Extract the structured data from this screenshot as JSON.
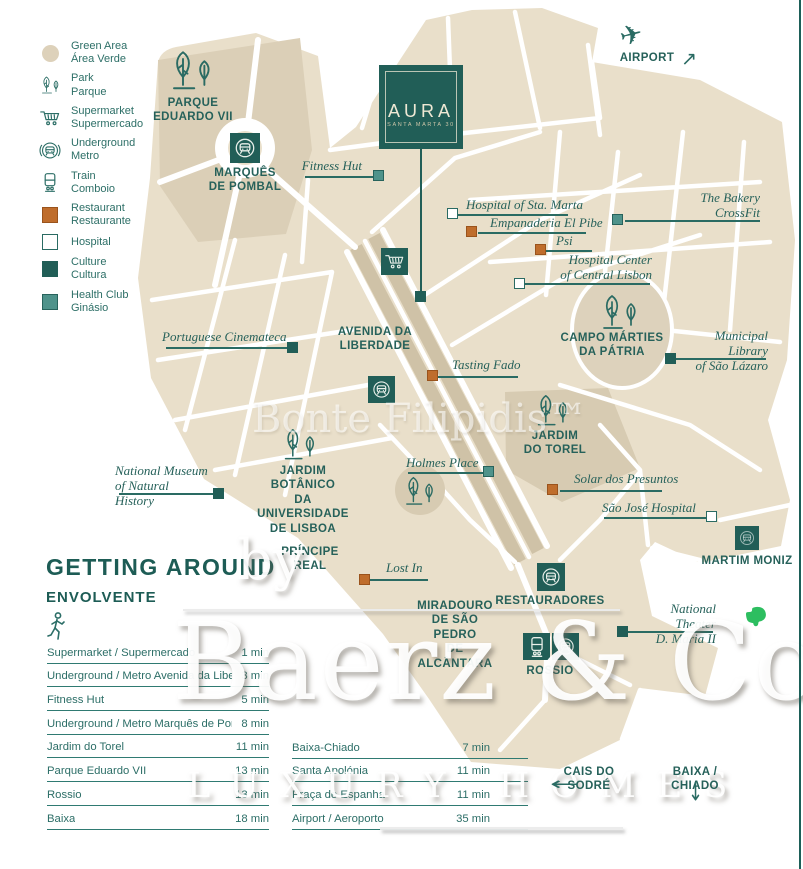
{
  "colors": {
    "teal": "#215e57",
    "teal_text": "#26615a",
    "orange": "#bf6d2c",
    "health_teal": "#4f938b",
    "beige": "#e9dfca",
    "evernote_green": "#2dbe60"
  },
  "icons": {
    "plane": "✈",
    "arrow_left": "←",
    "arrow_down": "↓",
    "arrow_up_right": "↗"
  },
  "legend": {
    "items": [
      {
        "id": "green-area",
        "label": "Green Area\nÁrea Verde"
      },
      {
        "id": "park",
        "label": "Park\nParque"
      },
      {
        "id": "supermarket",
        "label": "Supermarket\nSupermercado"
      },
      {
        "id": "underground",
        "label": "Underground\nMetro"
      },
      {
        "id": "train",
        "label": "Train\nComboio"
      },
      {
        "id": "restaurant",
        "label": "Restaurant\nRestaurante"
      },
      {
        "id": "hospital",
        "label": "Hospital"
      },
      {
        "id": "culture",
        "label": "Culture\nCultura"
      },
      {
        "id": "health-club",
        "label": "Health Club\nGinásio"
      }
    ]
  },
  "aura": {
    "title": "AURA",
    "subtitle": "SANTA MARTA 30"
  },
  "airport": {
    "label": "AIRPORT"
  },
  "areas": {
    "parque_eduardo": "PARQUE\nEDUARDO VII",
    "marques": "MARQUÊS\nDE POMBAL",
    "avenida": "AVENIDA DA\nLIBERDADE",
    "campo": "CAMPO MÁRTIES\nDA PÁTRIA",
    "torel": "JARDIM\nDO TOREL",
    "botanico": "JARDIM BOTÂNICO\nDA UNIVERSIDADE\nDE LISBOA",
    "principe": "PRÍNCIPE REAL",
    "martim": "MARTIM MONIZ",
    "restauradores": "RESTAURADORES",
    "miradouro": "MIRADOURO\nDE SÃO PEDRO\nDE ALCÂNTARA",
    "rossio": "ROSSIO",
    "cais": "CAIS DO SODRÉ",
    "baixa_chiado": "BAIXA / CHIADO"
  },
  "pois": {
    "fitness_hut": {
      "label": "Fitness Hut",
      "type": "health-club"
    },
    "sta_marta": {
      "label": "Hospital of Sta. Marta",
      "type": "hospital"
    },
    "empanaderia": {
      "label": "Empanaderia El Pibe",
      "type": "restaurant"
    },
    "psi": {
      "label": "Psi",
      "type": "restaurant"
    },
    "bakery": {
      "label": "The Bakery\nCrossFit",
      "type": "health-club"
    },
    "hospital_center": {
      "label": "Hospital Center\nof Central Lisbon",
      "type": "hospital"
    },
    "cinemateca": {
      "label": "Portuguese Cinemateca",
      "type": "culture"
    },
    "tasting_fado": {
      "label": "Tasting Fado",
      "type": "restaurant"
    },
    "library": {
      "label": "Municipal Library\nof São Lázaro",
      "type": "culture"
    },
    "holmes": {
      "label": "Holmes Place",
      "type": "health-club"
    },
    "solar": {
      "label": "Solar dos Presuntos",
      "type": "restaurant"
    },
    "sao_jose": {
      "label": "São José Hospital",
      "type": "hospital"
    },
    "museum": {
      "label": "National Museum\nof Natural History",
      "type": "culture"
    },
    "lost_in": {
      "label": "Lost In",
      "type": "restaurant"
    },
    "theater": {
      "label": "National Theater\nD. Maria II",
      "type": "culture"
    }
  },
  "getting_around": {
    "title": "GETTING AROUND",
    "subtitle": "ENVOLVENTE",
    "left_rows": [
      {
        "label": "Supermarket / Supermercado",
        "time": "1 min"
      },
      {
        "label": "Underground / Metro Avenida da Liberdade",
        "time": "3 min"
      },
      {
        "label": "Fitness Hut",
        "time": "5 min"
      },
      {
        "label": "Underground / Metro Marquês de Pombal",
        "time": "8 min"
      },
      {
        "label": "Jardim do Torel",
        "time": "11 min"
      },
      {
        "label": "Parque Eduardo VII",
        "time": "13 min"
      },
      {
        "label": "Rossio",
        "time": "13 min"
      },
      {
        "label": "Baixa",
        "time": "18 min"
      }
    ],
    "right_rows": [
      {
        "label": "Baixa-Chiado",
        "time": "7 min"
      },
      {
        "label": "Santa Apolónia",
        "time": "11 min"
      },
      {
        "label": "Praça de Espanha",
        "time": "11 min"
      },
      {
        "label": "Airport / Aeroporto",
        "time": "35 min"
      }
    ]
  },
  "watermarks": {
    "center": "Bonte Filipidis™",
    "by": "by",
    "brand": "Baerz & Co",
    "tagline": "LUXURY HOMES"
  }
}
